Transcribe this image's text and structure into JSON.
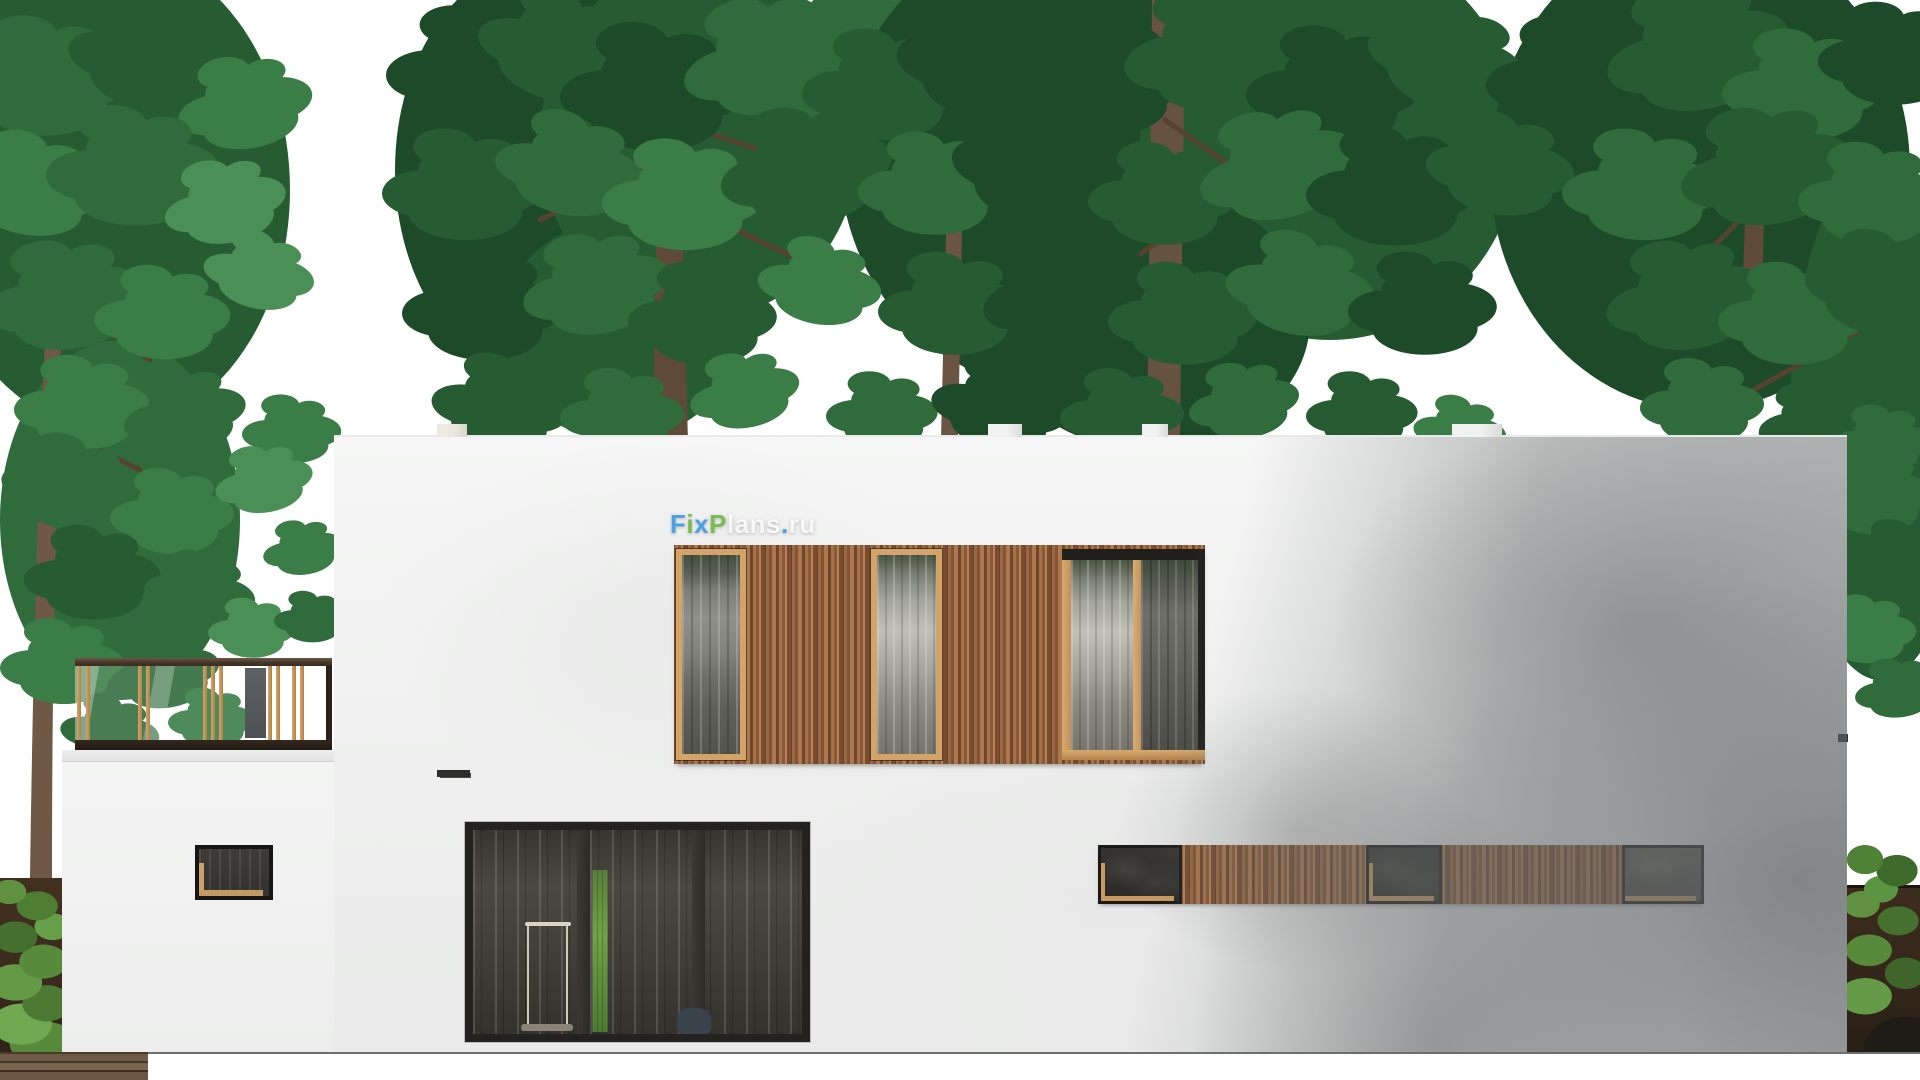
{
  "watermark": {
    "text": "FixPlans.ru",
    "segments": [
      {
        "text": "F"
      },
      {
        "text": "i"
      },
      {
        "text": "x"
      },
      {
        "text": "P"
      },
      {
        "text": "lans"
      },
      {
        "text": "."
      },
      {
        "text": "ru"
      }
    ]
  },
  "palette": {
    "sky": "#ffffff",
    "wall_lit": "#f1f2f0",
    "wall_shadow": "#b7bab9",
    "wood_cladding": "#96663f",
    "wood_frame": "#d3a368",
    "glass_dark": "#3a3935",
    "foliage_dark": "#1d4a28",
    "foliage_mid": "#2f6b3b",
    "foliage_light": "#4a8f55",
    "trunk": "#6a5440",
    "paving": "#9a9a98",
    "fence": "#3b2c20",
    "watermark_blue": "#3d9ee8",
    "watermark_green": "#70bd44"
  }
}
